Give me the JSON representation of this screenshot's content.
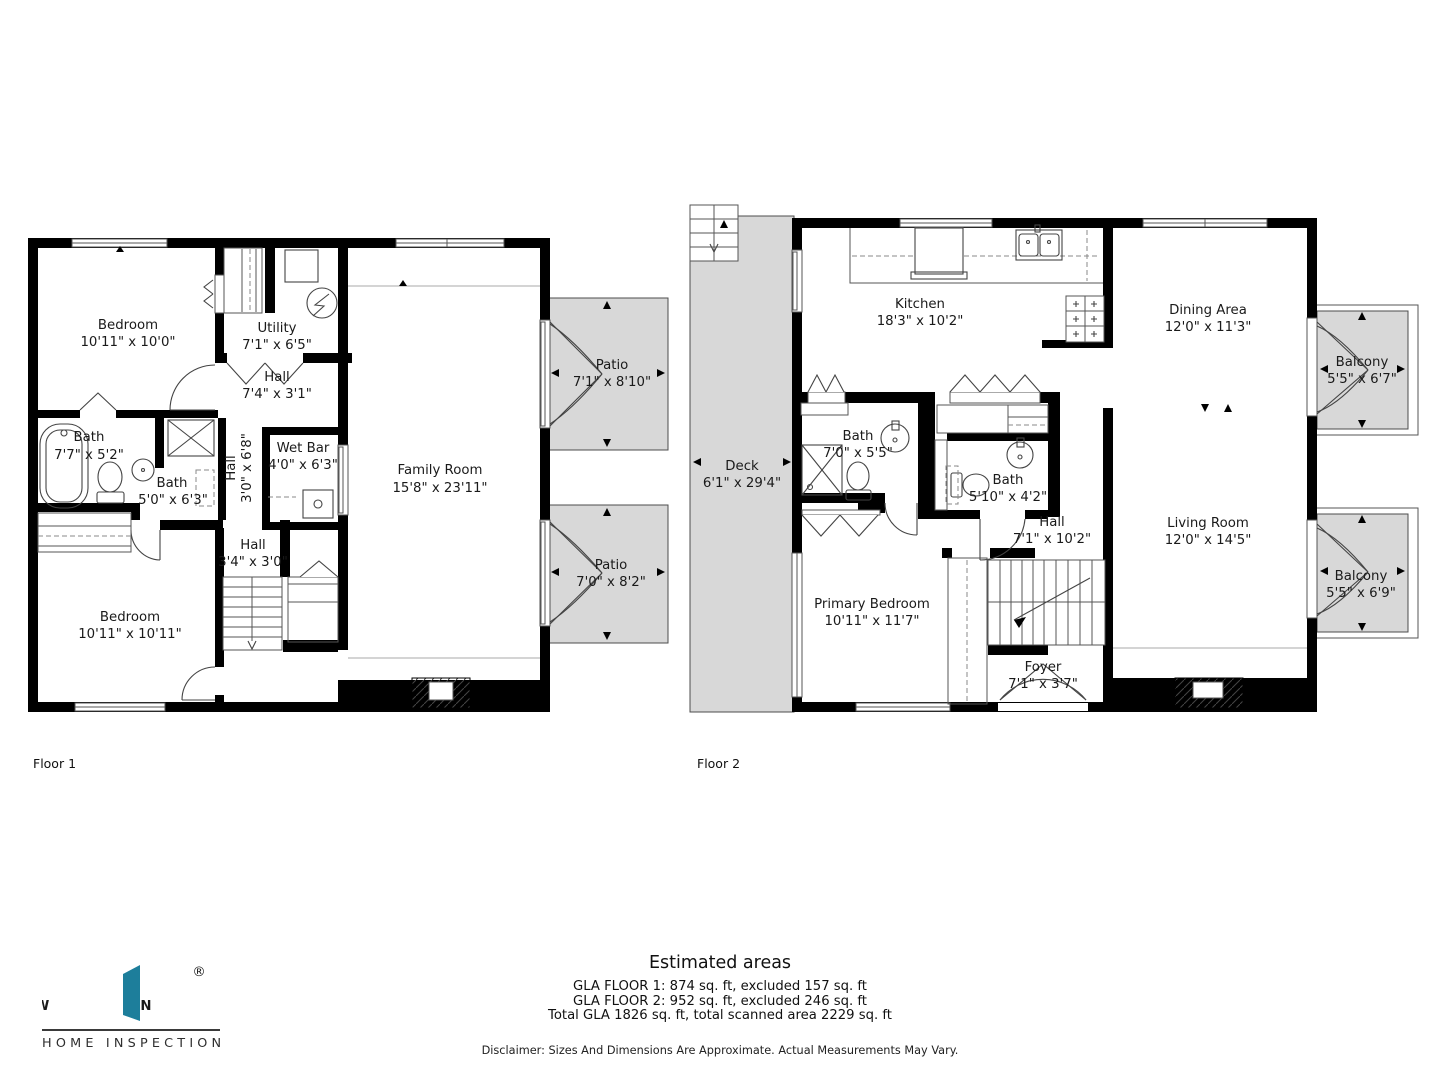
{
  "floor1": {
    "label": "Floor 1",
    "rooms": [
      {
        "name": "Bedroom",
        "dims": "10'11\" x 10'0\""
      },
      {
        "name": "Utility",
        "dims": "7'1\" x 6'5\""
      },
      {
        "name": "Hall",
        "dims": "7'4\" x 3'1\""
      },
      {
        "name": "Bath",
        "dims": "7'7\" x 5'2\""
      },
      {
        "name": "Bath",
        "dims": "5'0\" x 6'3\""
      },
      {
        "name": "Hall",
        "dims": "3'0\" x 6'8\""
      },
      {
        "name": "Wet Bar",
        "dims": "4'0\" x 6'3\""
      },
      {
        "name": "Family Room",
        "dims": "15'8\" x 23'11\""
      },
      {
        "name": "Hall",
        "dims": "3'4\" x 3'0\""
      },
      {
        "name": "Bedroom",
        "dims": "10'11\" x 10'11\""
      },
      {
        "name": "Patio",
        "dims": "7'1\" x 8'10\""
      },
      {
        "name": "Patio",
        "dims": "7'0\" x 8'2\""
      }
    ]
  },
  "floor2": {
    "label": "Floor 2",
    "rooms": [
      {
        "name": "Kitchen",
        "dims": "18'3\" x 10'2\""
      },
      {
        "name": "Dining Area",
        "dims": "12'0\" x 11'3\""
      },
      {
        "name": "Deck",
        "dims": "6'1\" x 29'4\""
      },
      {
        "name": "Bath",
        "dims": "7'0\" x 5'5\""
      },
      {
        "name": "Bath",
        "dims": "5'10\" x 4'2\""
      },
      {
        "name": "Hall",
        "dims": "7'1\" x 10'2\""
      },
      {
        "name": "Living Room",
        "dims": "12'0\" x 14'5\""
      },
      {
        "name": "Primary Bedroom",
        "dims": "10'11\" x 11'7\""
      },
      {
        "name": "Foyer",
        "dims": "7'1\" x 3'7\""
      },
      {
        "name": "Balcony",
        "dims": "5'5\" x 6'7\""
      },
      {
        "name": "Balcony",
        "dims": "5'5\" x 6'9\""
      }
    ]
  },
  "footer": {
    "title": "Estimated areas",
    "lines": [
      "GLA FLOOR 1: 874 sq. ft, excluded 157 sq. ft",
      "GLA FLOOR 2: 952 sq. ft, excluded 246 sq. ft",
      "Total GLA 1826 sq. ft, total scanned area 2229 sq. ft"
    ],
    "disclaimer": "Disclaimer: Sizes And Dimensions Are Approximate. Actual Measurements May Vary."
  },
  "logo": {
    "letter_w": "W",
    "letter_n": "N",
    "registered": "®",
    "tagline": "HOME INSPECTION",
    "brand_color": "#1d7e9b"
  },
  "colors": {
    "wall": "#000000",
    "outdoor_fill": "#d8d8d8",
    "text": "#1a1a1a"
  }
}
